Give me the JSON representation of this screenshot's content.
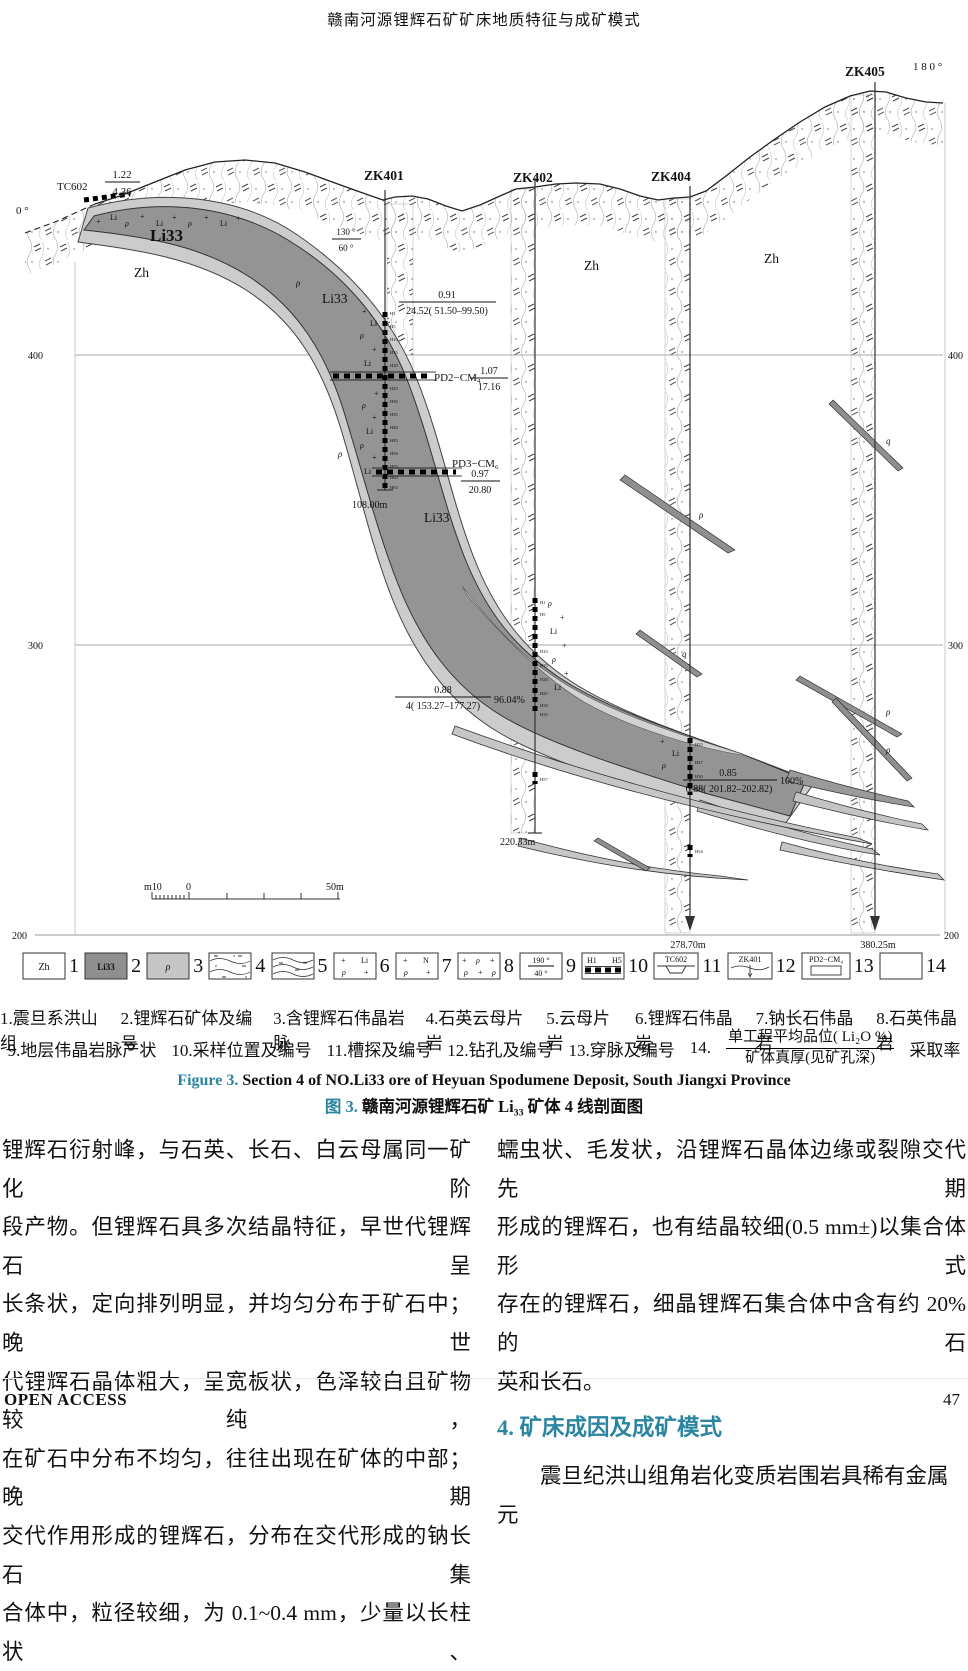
{
  "page": {
    "header_title": "赣南河源锂辉石矿矿床地质特征与成矿模式",
    "footer_left": "OPEN ACCESS",
    "page_number": "47"
  },
  "figure": {
    "boreholes": {
      "zk401": "ZK401",
      "zk402": "ZK402",
      "zk404": "ZK404",
      "zk405": "ZK405",
      "tc602": "TC602"
    },
    "angles": {
      "left": "0 °",
      "right": "1 8 0 °"
    },
    "elevations": {
      "e400": "400",
      "e300": "300",
      "e200": "200"
    },
    "depths": {
      "zk401": "108.00m",
      "zk402": "220.33m",
      "zk404": "278.70m",
      "zk405": "380.25m"
    },
    "strata": {
      "zh": "Zh",
      "li33": "Li33"
    },
    "adits": {
      "pd2": "PD2−CM₄",
      "pd3": "PD3−CM₆"
    },
    "sym": {
      "plus": "+",
      "li": "Li",
      "rho": "ρ",
      "q": "q"
    },
    "grades": {
      "tc602": {
        "top": "1.22",
        "bottom": "4.36"
      },
      "dip": {
        "top": "130 °",
        "bottom": "60 °"
      },
      "zk401": {
        "top": "0.91",
        "bottom": "24.52( 51.50–99.50)"
      },
      "pd2": {
        "top": "1.07",
        "bottom": "17.16"
      },
      "pd3": {
        "top": "0.97",
        "bottom": "20.80"
      },
      "zk402": {
        "top": "0.88",
        "bottom": "4( 153.27–177.27)",
        "recovery": "96.04%"
      },
      "zk404": {
        "top": "0.85",
        "bottom": "0.88( 201.82–202.82)",
        "recovery": "100%"
      }
    },
    "samples": {
      "zk401": [
        "H1",
        "H5",
        "H10",
        "H15",
        "H20",
        "H25",
        "H30",
        "H35",
        "H40",
        "H45",
        "H50",
        "H55",
        "H60",
        "H63"
      ],
      "zk402": [
        "H1",
        "H5",
        "H10",
        "H15",
        "H20",
        "H25",
        "H30",
        "H35",
        "H57"
      ],
      "zk404": [
        "H25",
        "H27",
        "H30",
        "H32",
        "H54"
      ]
    },
    "scalebar": {
      "left": "m10",
      "zero": "0",
      "right": "50m"
    }
  },
  "legend": {
    "items": [
      {
        "num": "1",
        "label": "Zh"
      },
      {
        "num": "2",
        "label": "Li33"
      },
      {
        "num": "3",
        "label": "ρ"
      },
      {
        "num": "4"
      },
      {
        "num": "5"
      },
      {
        "num": "6",
        "syms": [
          "+",
          "Li",
          "ρ",
          "+"
        ]
      },
      {
        "num": "7",
        "syms": [
          "+",
          "N",
          "ρ",
          "+"
        ]
      },
      {
        "num": "8",
        "syms": [
          "+",
          "ρ",
          "+",
          "ρ",
          "+",
          "ρ"
        ]
      },
      {
        "num": "9",
        "top": "190 °",
        "bottom": "40 °"
      },
      {
        "num": "10",
        "left": "H1",
        "right": "H5"
      },
      {
        "num": "11",
        "label": "TC602"
      },
      {
        "num": "12",
        "label": "ZK401"
      },
      {
        "num": "13",
        "label": "PD2−CM₄"
      },
      {
        "num": "14"
      }
    ],
    "captions_row1": [
      "1.震旦系洪山组",
      "2.锂辉石矿体及编号",
      "3.含锂辉石伟晶岩脉",
      "4.石英云母片岩",
      "5.云母片岩",
      "6.锂辉石伟晶岩",
      "7.钠长石伟晶岩",
      "8.石英伟晶岩"
    ],
    "captions_row2": [
      "9.地层伟晶岩脉产状",
      "10.采样位置及编号",
      "11.槽探及编号",
      "12.钻孔及编号",
      "13.穿脉及编号",
      "14."
    ],
    "item14_fraction": {
      "top": "单工程平均品位( Li₂O %)",
      "bottom": "矿体真厚(见矿孔深)",
      "suffix": "采取率"
    }
  },
  "caption": {
    "en_label": "Figure 3.",
    "en_text": " Section 4 of NO.Li33 ore of Heyuan Spodumene Deposit, South Jiangxi Province",
    "zh_label": "图 3.",
    "zh_text": " 赣南河源锂辉石矿 Li₃₃ 矿体 4 线剖面图"
  },
  "body": {
    "left_lines": [
      "锂辉石衍射峰，与石英、长石、白云母属同一矿化阶",
      "段产物。但锂辉石具多次结晶特征，早世代锂辉石呈",
      "长条状，定向排列明显，并均匀分布于矿石中；晚世",
      "代锂辉石晶体粗大，呈宽板状，色泽较白且矿物较纯，",
      "在矿石中分布不均匀，往往出现在矿体的中部；晚期",
      "交代作用形成的锂辉石，分布在交代形成的钠长石集",
      "合体中，粒径较细，为 0.1~0.4 mm，少量以长柱状、"
    ],
    "right_lines": [
      "蠕虫状、毛发状，沿锂辉石晶体边缘或裂隙交代先期",
      "形成的锂辉石，也有结晶较细(0.5 mm±)以集合体形式",
      "存在的锂辉石，细晶锂辉石集合体中含有约 20%的石",
      "英和长石。"
    ],
    "section_heading": "4. 矿床成因及成矿模式",
    "after_heading": "震旦纪洪山组角岩化变质岩围岩具稀有金属元"
  },
  "colors": {
    "accent_teal": "#2b84a0",
    "ore_dark": "#949494",
    "ore_light": "#c8c8c8",
    "halo": "#cccccc"
  }
}
